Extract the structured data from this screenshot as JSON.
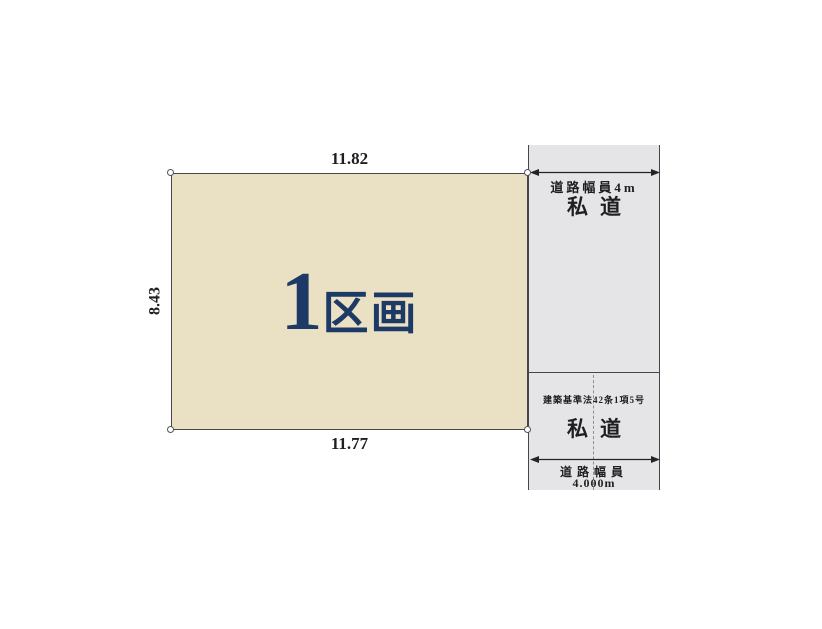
{
  "plot": {
    "label_number": "1",
    "label_suffix": "区画",
    "dim_top": "11.82",
    "dim_bottom": "11.77",
    "dim_left": "8.43",
    "dim_right": "8.44"
  },
  "road_upper": {
    "width_label": "道路幅員4m",
    "name": "私道"
  },
  "road_lower": {
    "law_label": "建築基準法42条1項5号",
    "name": "私道",
    "width_caption": "道路幅員",
    "width_value": "4.000m"
  },
  "colors": {
    "plot_fill": "#eae0c3",
    "road_fill": "#e5e5e7",
    "plot_label": "#1d3a66",
    "line": "#45454b",
    "text": "#1f1f1f"
  }
}
